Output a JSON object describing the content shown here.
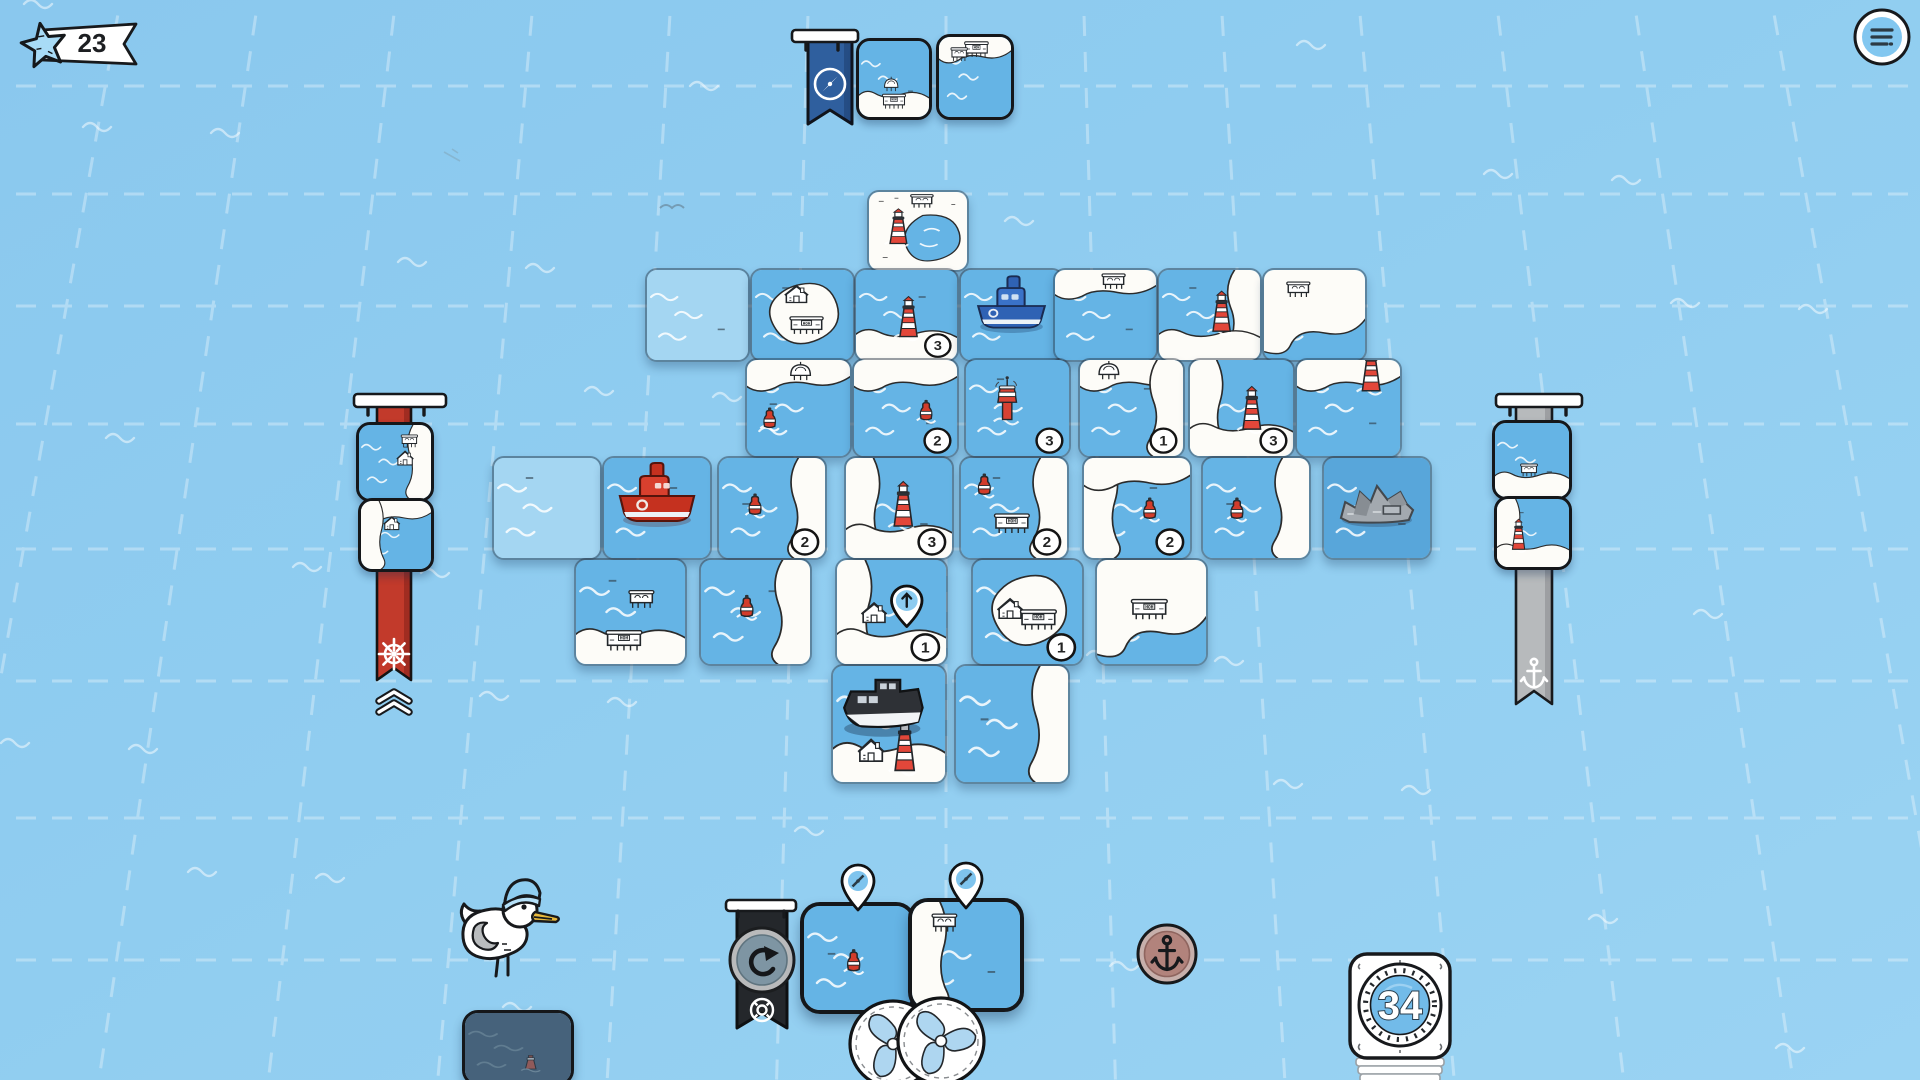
{
  "hud": {
    "score": {
      "value": "23",
      "icon": "starfish-icon"
    },
    "menu": {
      "icon": "hamburger-icon"
    },
    "deck": {
      "count": "34"
    },
    "queue": {
      "flag_icon": "compass-flag-icon",
      "tiles": [
        {
          "water": "mid",
          "land": [
            "bottom"
          ],
          "features": [
            [
              "dome",
              46,
              62
            ],
            [
              "warehouse",
              50,
              82
            ]
          ]
        },
        {
          "water": "mid",
          "land": [
            "top"
          ],
          "features": [
            [
              "warehouse",
              52,
              18
            ],
            [
              "stilt",
              28,
              26
            ]
          ]
        }
      ]
    },
    "left_goal": {
      "icon": "ship-wheel-icon",
      "color": "#c23a2b",
      "chevron_rank": 2,
      "tiles": [
        {
          "water": "mid",
          "land": [
            "right"
          ],
          "features": [
            [
              "house",
              64,
              52
            ],
            [
              "stilt",
              70,
              26
            ]
          ]
        },
        {
          "water": "mid",
          "land": [
            "top",
            "left"
          ],
          "features": [
            [
              "house",
              44,
              40
            ]
          ]
        }
      ]
    },
    "right_goal": {
      "icon": "anchor-icon",
      "color": "#b7babc",
      "tiles": [
        {
          "water": "mid",
          "land": [
            "bottom"
          ],
          "features": [
            [
              "stilt",
              46,
              68
            ]
          ]
        },
        {
          "water": "mid",
          "land": [
            "left",
            "bottom"
          ],
          "features": [
            [
              "lighthouse",
              30,
              74
            ]
          ]
        }
      ]
    },
    "hand": {
      "pin_icon": "compass-pin-icon",
      "tiles": [
        {
          "water": "mid",
          "land": [],
          "features": [
            [
              "buoy",
              46,
              60
            ]
          ]
        },
        {
          "water": "mid",
          "land": [
            "left"
          ],
          "features": [
            [
              "stilt",
              30,
              24
            ]
          ]
        }
      ]
    },
    "tokens": {
      "propellers": 2
    },
    "buttons": {
      "undo": "undo-arrow-icon",
      "restart": "life-ring-icon",
      "anchor": "anchor-icon"
    },
    "seagull": {
      "tile": {
        "water": "dim",
        "land": [],
        "features": [
          [
            "minilh",
            62,
            80
          ]
        ]
      }
    }
  },
  "board": {
    "tiles": [
      {
        "r": 0,
        "c": 3.4,
        "water": "mid",
        "land": [
          "fullbay"
        ],
        "features": [
          [
            "lighthouse",
            30,
            66
          ],
          [
            "stilt",
            54,
            16
          ]
        ]
      },
      {
        "r": 1,
        "c": 1.3,
        "water": "light",
        "land": [],
        "features": []
      },
      {
        "r": 1,
        "c": 2.3,
        "water": "mid",
        "land": [
          "center"
        ],
        "features": [
          [
            "house",
            44,
            34
          ],
          [
            "warehouse",
            54,
            64
          ]
        ]
      },
      {
        "r": 1,
        "c": 3.3,
        "water": "mid",
        "land": [
          "bottom"
        ],
        "features": [
          [
            "lighthouse",
            52,
            74
          ]
        ],
        "badge": "3"
      },
      {
        "r": 1,
        "c": 4.3,
        "water": "mid",
        "land": [],
        "features": [],
        "piece": "blue-ship"
      },
      {
        "r": 1,
        "c": 5.2,
        "water": "mid",
        "land": [
          "top"
        ],
        "features": [
          [
            "stilt",
            58,
            17
          ]
        ]
      },
      {
        "r": 1,
        "c": 6.2,
        "water": "mid",
        "land": [
          "right",
          "bottom"
        ],
        "features": [
          [
            "lighthouse",
            62,
            68
          ]
        ]
      },
      {
        "r": 1,
        "c": 7.2,
        "water": "mid",
        "land": [
          "most"
        ],
        "features": [
          [
            "stilt",
            34,
            26
          ]
        ]
      },
      {
        "r": 2,
        "c": 2.3,
        "water": "mid",
        "land": [
          "top"
        ],
        "features": [
          [
            "dome",
            52,
            17
          ],
          [
            "buoy",
            22,
            68
          ]
        ]
      },
      {
        "r": 2,
        "c": 3.3,
        "water": "mid",
        "land": [
          "top"
        ],
        "features": [
          [
            "buoy",
            70,
            60
          ]
        ],
        "badge": "2"
      },
      {
        "r": 2,
        "c": 4.35,
        "water": "mid",
        "land": [],
        "features": [
          [
            "tower",
            40,
            62
          ]
        ],
        "badge": "3"
      },
      {
        "r": 2,
        "c": 5.42,
        "water": "mid",
        "land": [
          "top",
          "right"
        ],
        "features": [
          [
            "dome",
            28,
            16
          ]
        ],
        "badge": "1"
      },
      {
        "r": 2,
        "c": 6.45,
        "water": "mid",
        "land": [
          "left",
          "bottom"
        ],
        "features": [
          [
            "lighthouse",
            60,
            72
          ]
        ],
        "badge": "3"
      },
      {
        "r": 2,
        "c": 7.45,
        "water": "mid",
        "land": [
          "top"
        ],
        "features": [
          [
            "lighthouse",
            72,
            32
          ]
        ]
      },
      {
        "r": 3,
        "c": 0.05,
        "water": "light",
        "land": [],
        "features": []
      },
      {
        "r": 3,
        "c": 1.05,
        "water": "mid",
        "land": [],
        "features": [],
        "piece": "red-ship"
      },
      {
        "r": 3,
        "c": 2.1,
        "water": "mid",
        "land": [
          "right"
        ],
        "features": [
          [
            "buoy",
            34,
            54
          ]
        ],
        "badge": "2"
      },
      {
        "r": 3,
        "c": 3.25,
        "water": "mid",
        "land": [
          "left",
          "bottom"
        ],
        "features": [
          [
            "lighthouse",
            54,
            68
          ]
        ],
        "badge": "3"
      },
      {
        "r": 3,
        "c": 4.3,
        "water": "mid",
        "land": [
          "right"
        ],
        "features": [
          [
            "buoy",
            22,
            34
          ],
          [
            "warehouse",
            48,
            68
          ]
        ],
        "badge": "2"
      },
      {
        "r": 3,
        "c": 5.42,
        "water": "mid",
        "land": [
          "left",
          "top"
        ],
        "features": [
          [
            "buoy",
            62,
            58
          ]
        ],
        "badge": "2"
      },
      {
        "r": 3,
        "c": 6.5,
        "water": "mid",
        "land": [
          "right"
        ],
        "features": [
          [
            "buoy",
            32,
            58
          ]
        ]
      },
      {
        "r": 3,
        "c": 7.6,
        "water": "deep",
        "land": [],
        "features": [],
        "piece": "grey-wreck"
      },
      {
        "r": 4,
        "c": 0.9,
        "water": "mid",
        "land": [
          "bottom"
        ],
        "features": [
          [
            "stilt",
            60,
            42
          ],
          [
            "warehouse",
            44,
            80
          ]
        ]
      },
      {
        "r": 4,
        "c": 2.0,
        "water": "mid",
        "land": [
          "right"
        ],
        "features": [
          [
            "buoy",
            42,
            52
          ]
        ]
      },
      {
        "r": 4,
        "c": 3.2,
        "water": "mid",
        "land": [
          "left",
          "bottom"
        ],
        "features": [
          [
            "house",
            34,
            58
          ]
        ],
        "badge": "1",
        "pin": [
          64,
          42
        ]
      },
      {
        "r": 4,
        "c": 4.4,
        "water": "mid",
        "land": [
          "center"
        ],
        "features": [
          [
            "house",
            34,
            54
          ],
          [
            "warehouse",
            60,
            60
          ]
        ],
        "badge": "1"
      },
      {
        "r": 4,
        "c": 5.5,
        "water": "mid",
        "land": [
          "most"
        ],
        "features": [
          [
            "warehouse",
            48,
            50
          ]
        ]
      },
      {
        "r": 5,
        "c": 3.2,
        "water": "mid",
        "land": [
          "bottom"
        ],
        "features": [
          [
            "house",
            34,
            80
          ],
          [
            "lighthouse",
            64,
            90
          ]
        ],
        "piece": "black-tug"
      },
      {
        "r": 5,
        "c": 4.25,
        "water": "mid",
        "land": [
          "right"
        ],
        "features": []
      }
    ]
  },
  "art": {
    "warehouse_sign": "HOH"
  },
  "colors": {
    "water_light": "#a4d6f2",
    "water_mid": "#65b4e5",
    "water_deep": "#58a6da",
    "water_dim": "#46627b",
    "island": "#fdfcf8",
    "lighthouse_red": "#e2473a",
    "banner_red": "#c23a2b",
    "banner_grey": "#b7babc",
    "flag_blue": "#2f5f9e",
    "flag_black": "#24272b",
    "token_blade": "#aed6f0",
    "deck_disc": "#72bbe9",
    "anchor_btn": "#b2837c",
    "star_blue": "#a8dbf6"
  }
}
